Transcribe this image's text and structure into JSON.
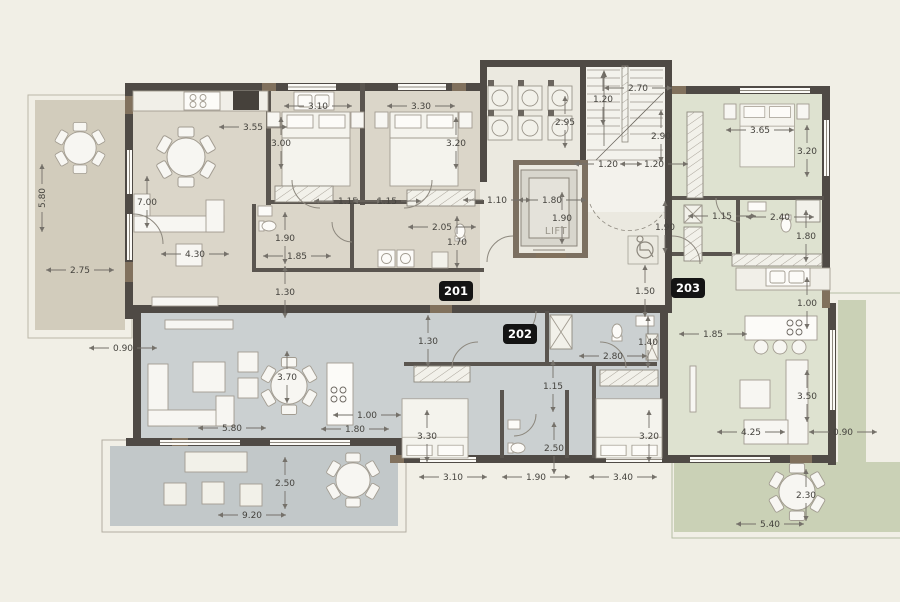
{
  "drawing": {
    "type": "residential apartment floor plan",
    "units_visible": [
      "201",
      "202",
      "203"
    ],
    "lift_label": "LIFT"
  },
  "colors": {
    "background": "#f1efe6",
    "unit_201_fill": "#dbd6c9",
    "unit_201_balcony": "#d2ccbc",
    "unit_202_fill": "#cbd0d1",
    "unit_202_terrace": "#c2c8c9",
    "unit_203_fill": "#dee2d0",
    "unit_203_terrace": "#cad1b6",
    "core_fill": "#ebe9e0",
    "wall": "#4f4a45",
    "wall_accent_wood": "#81715d",
    "dimension_text": "#45433e",
    "badge_background": "#141414",
    "badge_text": "#ffffff"
  },
  "badges": [
    {
      "label": "201",
      "x": 456,
      "y": 291
    },
    {
      "label": "202",
      "x": 520,
      "y": 334
    },
    {
      "label": "203",
      "x": 688,
      "y": 288
    }
  ],
  "dimensions": {
    "unit_201": [
      {
        "v": "3.55",
        "x": 253,
        "y": 127
      },
      {
        "v": "3.10",
        "x": 318,
        "y": 106
      },
      {
        "v": "3.30",
        "x": 421,
        "y": 106
      },
      {
        "v": "3.00",
        "x": 281,
        "y": 143,
        "o": "v"
      },
      {
        "v": "3.20",
        "x": 456,
        "y": 143,
        "o": "v"
      },
      {
        "v": "1.15",
        "x": 348,
        "y": 201
      },
      {
        "v": "1.15",
        "x": 387,
        "y": 201
      },
      {
        "v": "1.10",
        "x": 497,
        "y": 200
      },
      {
        "v": "2.05",
        "x": 442,
        "y": 227
      },
      {
        "v": "1.70",
        "x": 457,
        "y": 242,
        "o": "v"
      },
      {
        "v": "1.90",
        "x": 285,
        "y": 238,
        "o": "v"
      },
      {
        "v": "1.85",
        "x": 297,
        "y": 256
      },
      {
        "v": "1.30",
        "x": 285,
        "y": 292,
        "o": "v"
      },
      {
        "v": "4.30",
        "x": 195,
        "y": 254
      },
      {
        "v": "7.00",
        "x": 147,
        "y": 202,
        "o": "v"
      },
      {
        "v": "2.75",
        "x": 80,
        "y": 270
      },
      {
        "v": "5.80",
        "x": 42,
        "y": 198,
        "r": -90
      }
    ],
    "core": [
      {
        "v": "2.70",
        "x": 638,
        "y": 88
      },
      {
        "v": "1.20",
        "x": 603,
        "y": 99,
        "o": "v"
      },
      {
        "v": "2.95",
        "x": 565,
        "y": 122,
        "o": "v"
      },
      {
        "v": "2.90",
        "x": 661,
        "y": 136,
        "o": "v"
      },
      {
        "v": "1.20",
        "x": 608,
        "y": 164
      },
      {
        "v": "1.20",
        "x": 654,
        "y": 164
      },
      {
        "v": "1.80",
        "x": 552,
        "y": 200
      },
      {
        "v": "1.90",
        "x": 562,
        "y": 218,
        "o": "v"
      },
      {
        "v": "1.90",
        "x": 665,
        "y": 227,
        "o": "v"
      },
      {
        "v": "1.50",
        "x": 645,
        "y": 291,
        "o": "v"
      }
    ],
    "unit_203": [
      {
        "v": "3.65",
        "x": 760,
        "y": 130
      },
      {
        "v": "3.20",
        "x": 807,
        "y": 151,
        "o": "v"
      },
      {
        "v": "1.15",
        "x": 722,
        "y": 216
      },
      {
        "v": "2.40",
        "x": 780,
        "y": 217
      },
      {
        "v": "1.80",
        "x": 806,
        "y": 236,
        "o": "v"
      },
      {
        "v": "1.00",
        "x": 807,
        "y": 303,
        "o": "v"
      },
      {
        "v": "1.85",
        "x": 713,
        "y": 334
      },
      {
        "v": "3.50",
        "x": 807,
        "y": 396,
        "o": "v"
      },
      {
        "v": "4.25",
        "x": 751,
        "y": 432
      },
      {
        "v": "0.90",
        "x": 843,
        "y": 432
      },
      {
        "v": "2.30",
        "x": 806,
        "y": 495,
        "o": "v"
      },
      {
        "v": "5.40",
        "x": 770,
        "y": 524
      }
    ],
    "unit_202": [
      {
        "v": "0.90",
        "x": 123,
        "y": 348
      },
      {
        "v": "1.30",
        "x": 428,
        "y": 341,
        "o": "v"
      },
      {
        "v": "3.70",
        "x": 287,
        "y": 377,
        "o": "v"
      },
      {
        "v": "1.00",
        "x": 367,
        "y": 415
      },
      {
        "v": "1.80",
        "x": 355,
        "y": 429
      },
      {
        "v": "5.80",
        "x": 232,
        "y": 428
      },
      {
        "v": "1.15",
        "x": 553,
        "y": 386,
        "o": "v"
      },
      {
        "v": "2.80",
        "x": 613,
        "y": 356
      },
      {
        "v": "1.40",
        "x": 648,
        "y": 342,
        "o": "v"
      },
      {
        "v": "3.30",
        "x": 427,
        "y": 436,
        "o": "v"
      },
      {
        "v": "2.50",
        "x": 554,
        "y": 448,
        "o": "v"
      },
      {
        "v": "3.20",
        "x": 649,
        "y": 436,
        "o": "v"
      },
      {
        "v": "3.10",
        "x": 453,
        "y": 477
      },
      {
        "v": "1.90",
        "x": 536,
        "y": 477
      },
      {
        "v": "3.40",
        "x": 623,
        "y": 477
      },
      {
        "v": "2.50",
        "x": 285,
        "y": 483,
        "o": "v"
      },
      {
        "v": "9.20",
        "x": 252,
        "y": 515
      }
    ]
  }
}
